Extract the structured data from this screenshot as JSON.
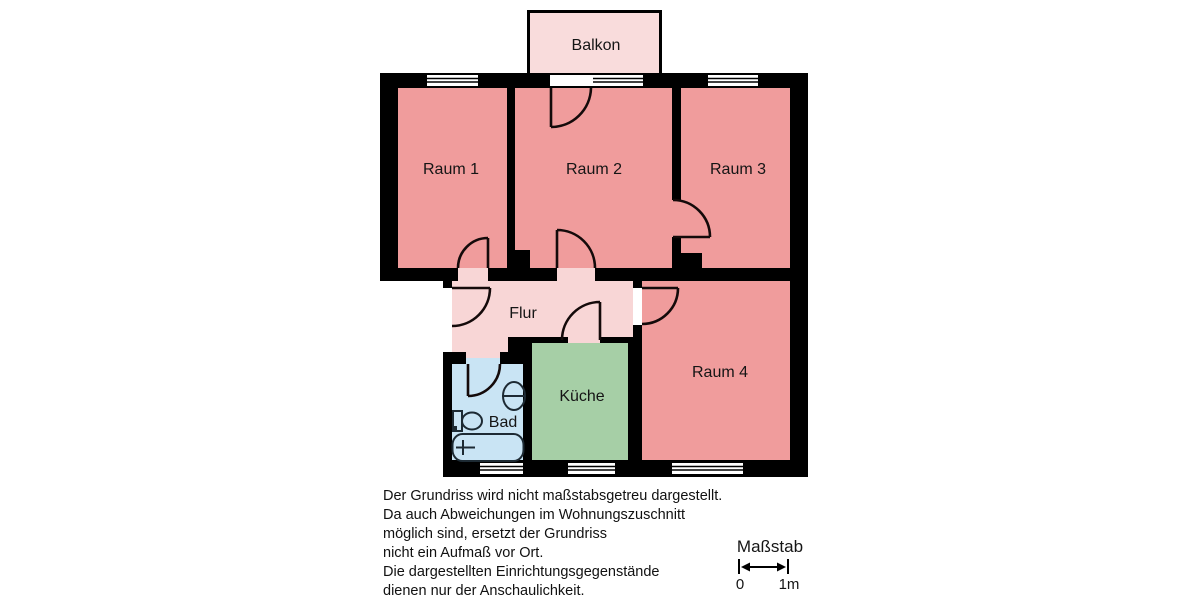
{
  "floorplan": {
    "wall_color": "#000000",
    "outside_color": "#ffffff",
    "rooms": [
      {
        "id": "raum-1",
        "label": "Raum 1",
        "color": "#f09c9c"
      },
      {
        "id": "raum-2",
        "label": "Raum 2",
        "color": "#f09c9c"
      },
      {
        "id": "raum-3",
        "label": "Raum 3",
        "color": "#f09c9c"
      },
      {
        "id": "raum-4",
        "label": "Raum 4",
        "color": "#f09c9c"
      },
      {
        "id": "flur",
        "label": "Flur",
        "color": "#f8d6d6"
      },
      {
        "id": "kueche",
        "label": "Küche",
        "color": "#a6cfa6"
      },
      {
        "id": "bad",
        "label": "Bad",
        "color": "#c9e4f4"
      },
      {
        "id": "balkon",
        "label": "Balkon",
        "color": "#f9dcdc"
      }
    ],
    "fixtures": [
      {
        "id": "bathtub"
      },
      {
        "id": "toilet"
      },
      {
        "id": "sink"
      }
    ]
  },
  "disclaimer": {
    "lines": [
      "Der Grundriss wird nicht maßstabsgetreu dargestellt.",
      "Da auch Abweichungen im Wohnungszuschnitt",
      "möglich sind, ersetzt der Grundriss",
      "nicht ein Aufmaß vor Ort.",
      "Die dargestellten Einrichtungsgegenstände",
      "dienen nur der Anschaulichkeit."
    ]
  },
  "scale": {
    "title": "Maßstab",
    "start_label": "0",
    "end_label": "1m"
  }
}
